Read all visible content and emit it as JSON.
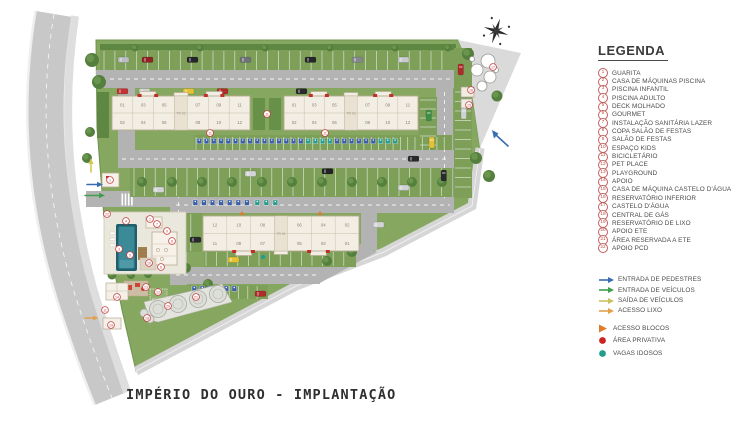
{
  "title": "IMPÉRIO DO OURO - IMPLANTAÇÃO",
  "legend": {
    "title": "LEGENDA",
    "items": [
      {
        "num": "1",
        "label": "GUARITA"
      },
      {
        "num": "2",
        "label": "CASA DE MÁQUINAS PISCINA"
      },
      {
        "num": "3",
        "label": "PISCINA INFANTIL"
      },
      {
        "num": "4",
        "label": "PISCINA ADULTO"
      },
      {
        "num": "5",
        "label": "DECK MOLHADO"
      },
      {
        "num": "6",
        "label": "GOURMET"
      },
      {
        "num": "7",
        "label": "INSTALAÇÃO SANITÁRIA LAZER"
      },
      {
        "num": "8",
        "label": "COPA SALÃO DE FESTAS"
      },
      {
        "num": "9",
        "label": "SALÃO DE FESTAS"
      },
      {
        "num": "10",
        "label": "ESPAÇO KIDS"
      },
      {
        "num": "11",
        "label": "BICICLETÁRIO"
      },
      {
        "num": "12",
        "label": "PET PLACE"
      },
      {
        "num": "13",
        "label": "PLAYGROUND"
      },
      {
        "num": "14",
        "label": "APOIO"
      },
      {
        "num": "15",
        "label": "CASA DE MÁQUINA CASTELO D'ÁGUA"
      },
      {
        "num": "16",
        "label": "RESERVATÓRIO INFERIOR"
      },
      {
        "num": "17",
        "label": "CASTELO D'ÁGUA"
      },
      {
        "num": "18",
        "label": "CENTRAL DE GÁS"
      },
      {
        "num": "19",
        "label": "RESERVATÓRIO DE LIXO"
      },
      {
        "num": "20",
        "label": "APOIO ETE"
      },
      {
        "num": "21",
        "label": "ÁREA RESERVADA A ETE"
      },
      {
        "num": "22",
        "label": "APOIO PCD"
      }
    ],
    "arrows": [
      {
        "name": "pedestrian-entrance-arrow",
        "color": "#3a6db0",
        "label": "ENTRADA DE PEDESTRES"
      },
      {
        "name": "vehicle-entrance-arrow",
        "color": "#3f9e4d",
        "label": "ENTRADA DE VEÍCULOS"
      },
      {
        "name": "vehicle-exit-arrow",
        "color": "#c9c15e",
        "label": "SAÍDA DE VEÍCULOS"
      },
      {
        "name": "trash-access-arrow",
        "color": "#e2a04a",
        "label": "ACESSO LIXO"
      }
    ],
    "symbols": [
      {
        "name": "blocks-access-triangle",
        "type": "triangle",
        "color": "#e07b2a",
        "label": "ACESSO BLOCOS"
      },
      {
        "name": "private-area-dot",
        "type": "dot",
        "color": "#cc2222",
        "label": "ÁREA PRIVATIVA"
      },
      {
        "name": "senior-parking-dot",
        "type": "dot",
        "color": "#1f9e8e",
        "label": "VAGAS IDOSOS"
      }
    ]
  },
  "towers": [
    {
      "name": "TR 02",
      "x": 112,
      "y": 96,
      "w": 138,
      "h": 34,
      "bumps": "top",
      "top": [
        "01",
        "03",
        "05",
        "07",
        "09",
        "11"
      ],
      "bottom": [
        "02",
        "04",
        "06",
        "08",
        "10",
        "12"
      ]
    },
    {
      "name": "TR 03",
      "x": 284,
      "y": 96,
      "w": 134,
      "h": 34,
      "bumps": "top",
      "top": [
        "01",
        "03",
        "05",
        "07",
        "09",
        "11"
      ],
      "bottom": [
        "02",
        "04",
        "06",
        "08",
        "10",
        "12"
      ]
    },
    {
      "name": "TR 01",
      "x": 203,
      "y": 216,
      "w": 156,
      "h": 35,
      "bumps": "bottom",
      "top": [
        "12",
        "10",
        "08",
        "06",
        "04",
        "02"
      ],
      "bottom": [
        "11",
        "09",
        "07",
        "05",
        "03",
        "01"
      ]
    }
  ],
  "plan_markers": [
    {
      "n": "1",
      "x": 110,
      "y": 180
    },
    {
      "n": "2",
      "x": 150,
      "y": 219
    },
    {
      "n": "3",
      "x": 119,
      "y": 249
    },
    {
      "n": "4",
      "x": 126,
      "y": 221
    },
    {
      "n": "5",
      "x": 130,
      "y": 255
    },
    {
      "n": "6",
      "x": 161,
      "y": 267
    },
    {
      "n": "7",
      "x": 157,
      "y": 224
    },
    {
      "n": "8",
      "x": 172,
      "y": 241
    },
    {
      "n": "9",
      "x": 167,
      "y": 231
    },
    {
      "n": "10",
      "x": 149,
      "y": 263
    },
    {
      "n": "11",
      "x": 267,
      "y": 114
    },
    {
      "n": "11",
      "x": 210,
      "y": 133
    },
    {
      "n": "11",
      "x": 325,
      "y": 133
    },
    {
      "n": "11",
      "x": 105,
      "y": 310
    },
    {
      "n": "12",
      "x": 158,
      "y": 292
    },
    {
      "n": "13",
      "x": 146,
      "y": 287
    },
    {
      "n": "14",
      "x": 117,
      "y": 297
    },
    {
      "n": "15",
      "x": 469,
      "y": 105
    },
    {
      "n": "16",
      "x": 471,
      "y": 90
    },
    {
      "n": "17",
      "x": 493,
      "y": 67
    },
    {
      "n": "18",
      "x": 147,
      "y": 318
    },
    {
      "n": "19",
      "x": 111,
      "y": 325
    },
    {
      "n": "20",
      "x": 168,
      "y": 306
    },
    {
      "n": "21",
      "x": 196,
      "y": 297
    },
    {
      "n": "22",
      "x": 107,
      "y": 214
    }
  ],
  "colors": {
    "grass": "#86a75f",
    "parking_green": "#7d9f58",
    "hedge": "#5d8743",
    "road": "#b3b3b3",
    "perimeter_road": "#c8c8c8",
    "sidewalk": "#dcdcdc",
    "building_fill": "#f3eee4",
    "building_stroke": "#b8aa92",
    "unit_text": "#8c7e6a",
    "tower_label": "#a39a8a",
    "marker_red": "#c34040",
    "facade_red": "#c03028",
    "pool_dark": "#205f6b",
    "pool_light": "#3b8a97",
    "pcd_blue": "#3a5fa8",
    "idoso_teal": "#2a9d8f",
    "access_orange": "#e07b2a"
  }
}
